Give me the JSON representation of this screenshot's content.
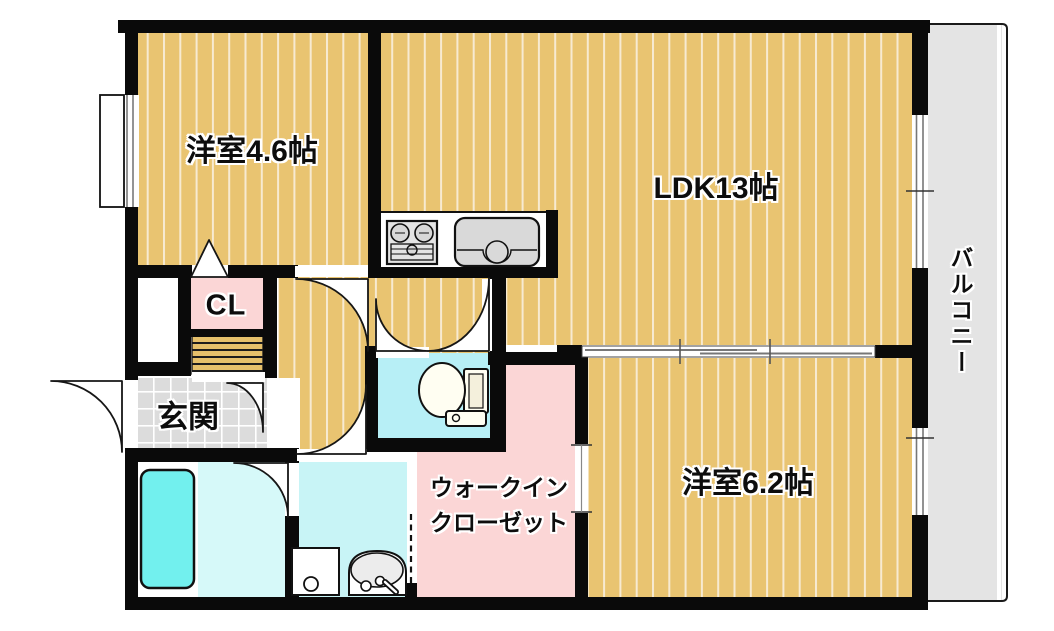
{
  "floorplan": {
    "type": "japanese-apartment-floorplan",
    "rooms": {
      "western_4_6": {
        "label": "洋室4.6帖"
      },
      "ldk": {
        "label": "LDK13帖"
      },
      "western_6_2": {
        "label": "洋室6.2帖"
      },
      "closet": {
        "label": "CL"
      },
      "entrance": {
        "label": "玄関"
      },
      "walk_in_closet": {
        "line1": "ウォークイン",
        "line2": "クローゼット"
      },
      "balcony": {
        "label": "バルコニー"
      }
    },
    "fixtures": [
      "gas-stove",
      "kitchen-sink",
      "toilet",
      "bathtub",
      "washbasin",
      "washing-machine-pan",
      "shoe-shelf",
      "sliding-partition",
      "windows",
      "hinged-doors",
      "folding-door-dashed"
    ],
    "colors": {
      "flooring": "#e9c471",
      "flooring_stripe": "#f7ead1",
      "closet_pink": "#fbd6d6",
      "toilet_cyan": "#b7eff6",
      "washroom_cyan": "#c8f4f6",
      "bath_floor_cyan": "#d6f9f9",
      "bathtub_cyan": "#72f0ee",
      "entrance_tile": "#dcdcdc",
      "balcony_gray": "#e4e4e4",
      "wall_black": "#0a0a0a"
    }
  }
}
